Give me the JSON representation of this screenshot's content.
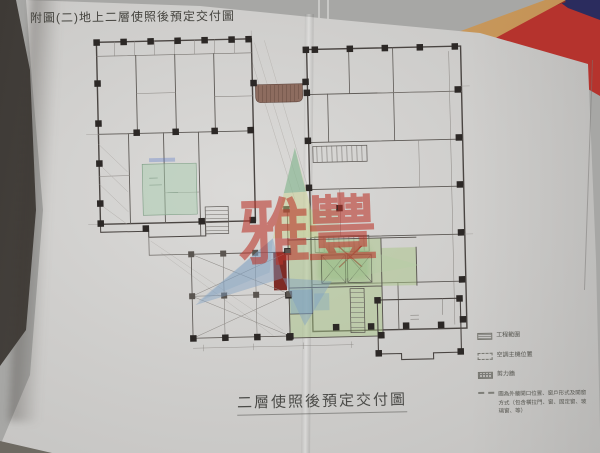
{
  "page": {
    "top_title": "附圖(二)地上二層使照後預定交付圖",
    "bottom_title": "二層使照後預定交付圖"
  },
  "watermark": {
    "char1": "雅",
    "char2": "豐",
    "red": "#ba3429",
    "blue": "#7da3c3",
    "green": "#ccd68e"
  },
  "legend": {
    "items": [
      {
        "symbol": "hatched-box",
        "label": "工程範圍"
      },
      {
        "symbol": "dashed-box",
        "label": "空調主機位置"
      },
      {
        "symbol": "grid-box",
        "label": "剪力牆"
      },
      {
        "symbol": "dashed-line",
        "label": "圖為外牆開口位置、窗戶形式及開窗方式（包含橫拉門、窗、固定窗、玻璃窗、等）"
      }
    ]
  },
  "colors": {
    "paper": "#cfcecc",
    "ink": "#4a4542",
    "folder_red": "#b5332d",
    "folder_blue": "#2b2c5e",
    "desk_wood": "#c59a5c",
    "plan_green_tint": "#aac687",
    "plan_blue_tint": "#6e9bc3",
    "shaft_dark_red": "#7e2b26"
  }
}
